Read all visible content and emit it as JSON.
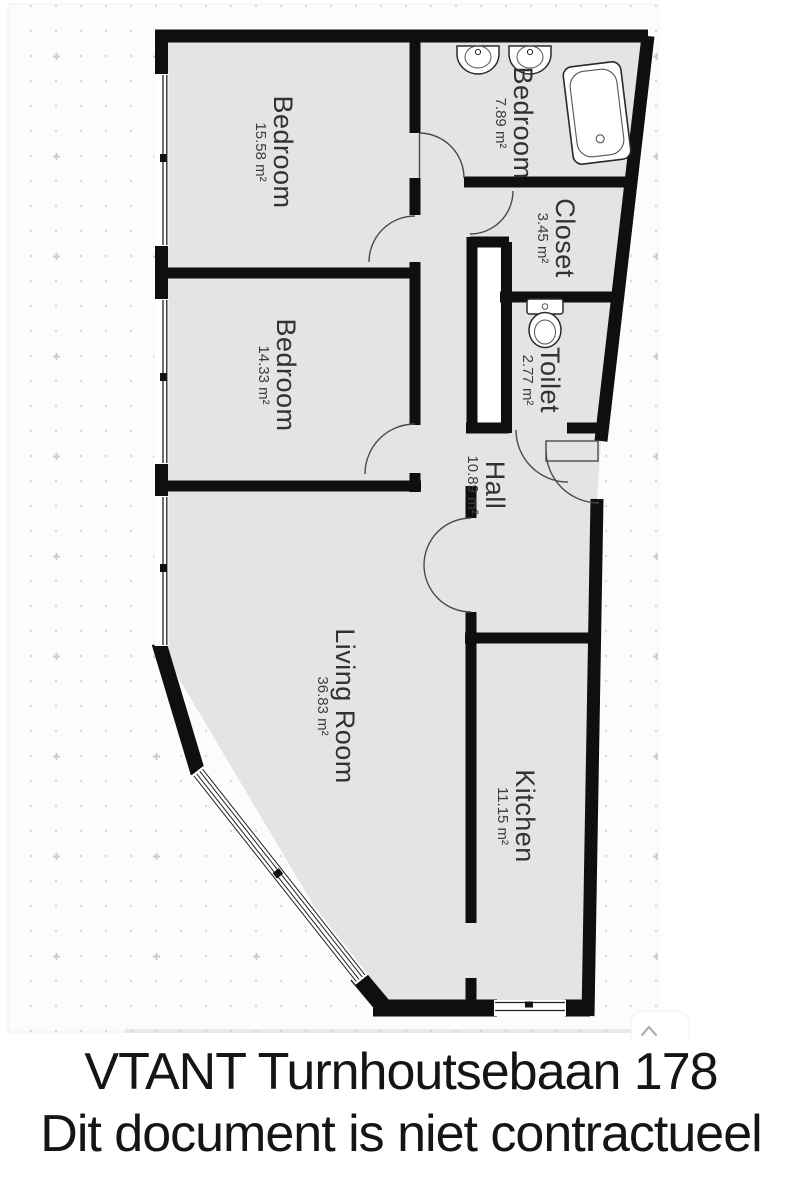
{
  "plan": {
    "rooms": [
      {
        "name": "Bedroom",
        "area": "15.58 m²"
      },
      {
        "name": "Bedroom",
        "area": "7.89 m²"
      },
      {
        "name": "Closet",
        "area": "3.45 m²"
      },
      {
        "name": "Toilet",
        "area": "2.77 m²"
      },
      {
        "name": "Bedroom",
        "area": "14.33 m²"
      },
      {
        "name": "Hall",
        "area": "10.89 m²"
      },
      {
        "name": "Living Room",
        "area": "36.83 m²"
      },
      {
        "name": "Kitchen",
        "area": "11.15 m²"
      }
    ],
    "fixtures": [
      "sink",
      "sink",
      "bathtub",
      "toilet"
    ],
    "colors": {
      "wall": "#0f0f0f",
      "floor": "#e4e4e4",
      "canvas": "#fcfcfc",
      "dot": "#d8d8d8",
      "fixture_line": "#2a2a2a",
      "door_line": "#4a4a4a"
    }
  },
  "caption": {
    "line1": "VTANT Turnhoutsebaan 178",
    "line2": "Dit document is niet contractueel"
  },
  "scroll_button": {
    "icon": "chevron-up"
  }
}
